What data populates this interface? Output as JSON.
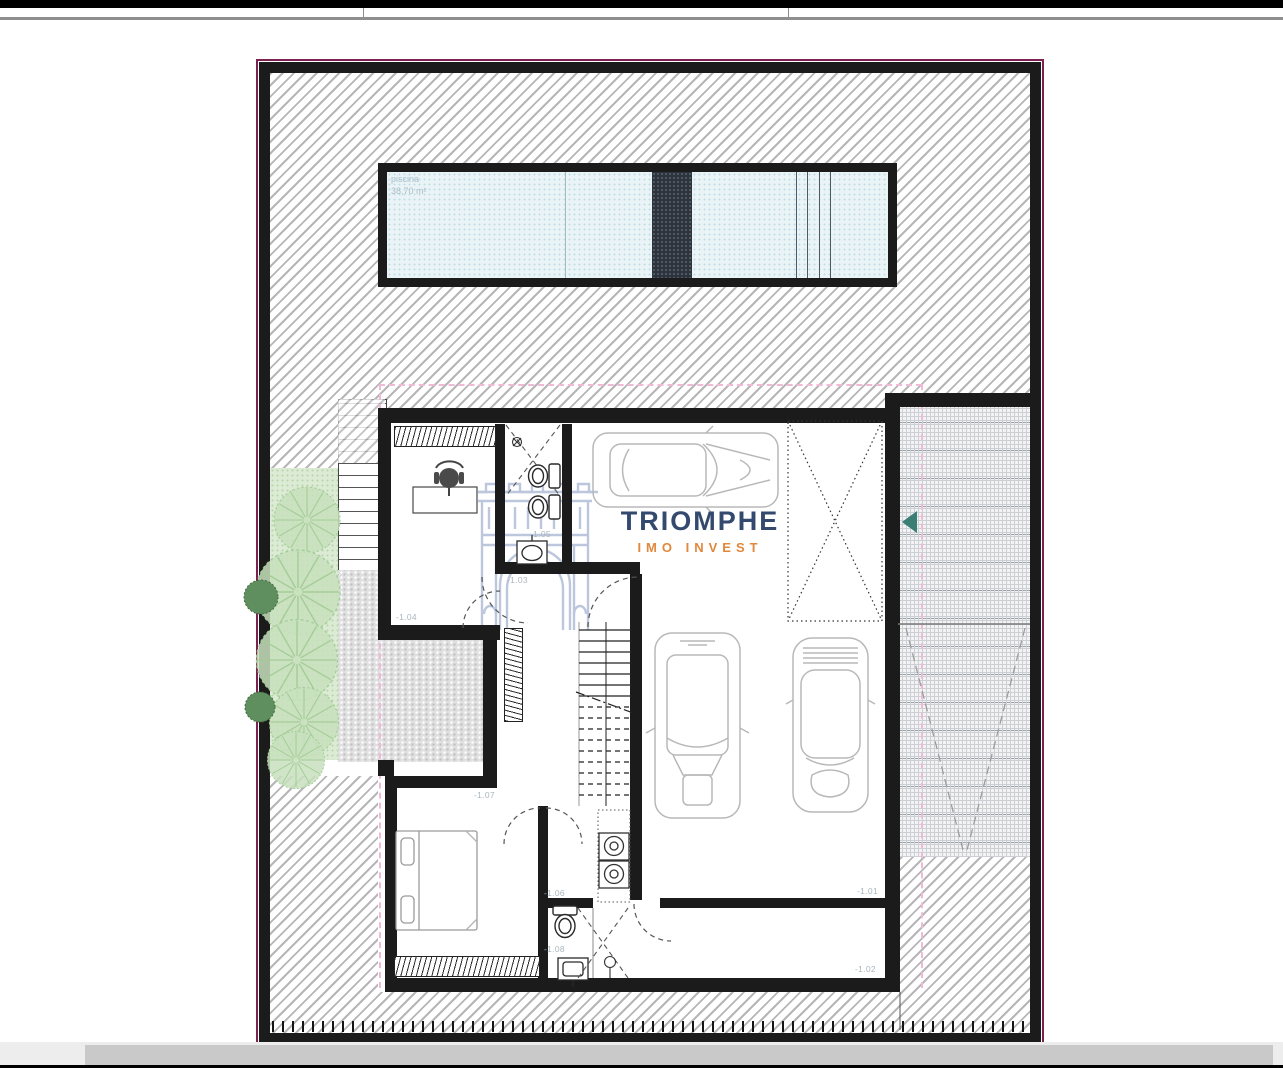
{
  "plan": {
    "pool": {
      "label": "piscina",
      "area": "38,70 m²"
    },
    "logo": {
      "title": "TRIOMPHE",
      "subtitle": "IMO INVEST"
    },
    "levels": {
      "l101": "-1.01",
      "l102": "-1.02",
      "l103": "-1.03",
      "l104": "-1.04",
      "l105": "-1.05",
      "l106": "-1.06",
      "l107": "-1.07",
      "l108": "-1.08"
    },
    "colors": {
      "wall": "#1b1b1b",
      "property_line": "#7c2150",
      "setback_line": "#f0bad6",
      "logo_title": "#33496e",
      "logo_subtitle": "#e0883b",
      "entry_arrow": "#3b7e74",
      "pool_water": "#eaf4f7",
      "garden": "#dcebd4"
    }
  }
}
